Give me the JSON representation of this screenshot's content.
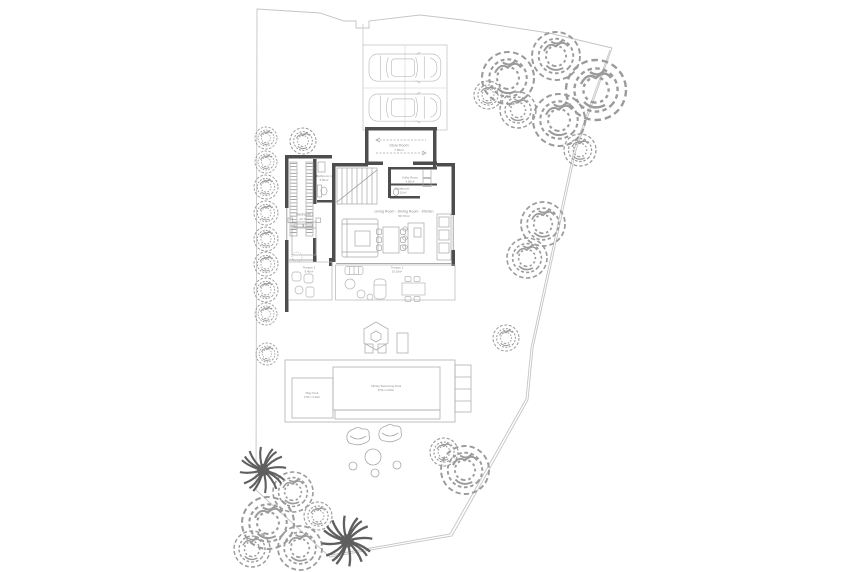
{
  "title": "Villa ground floor site plan",
  "colors": {
    "wall": "#4d4d4d",
    "furniture_line": "#a6a6a6",
    "boundary_line": "#c4c4c4",
    "vegetation_line": "#9b9b9b",
    "label_text": "#8a8a8a",
    "background": "#ffffff"
  },
  "rooms": [
    {
      "name": "Store Room",
      "area": "7.90m²"
    },
    {
      "name": "Bathroom 1",
      "area": "6.50m²"
    },
    {
      "name": "Utility Room",
      "area": "4.50m²"
    },
    {
      "name": "Cloakroom",
      "area": "3.10m²"
    },
    {
      "name": "Living Room · Dining Room · Kitchen",
      "area": "58.70m²"
    },
    {
      "name": "Bedroom 1",
      "area": "23.70m²"
    },
    {
      "name": "Terrace 2",
      "area": "9.40m²"
    },
    {
      "name": "Terrace 1",
      "area": "19.20m²"
    }
  ],
  "pools": [
    {
      "name": "Play Pool",
      "size": "3.50 x 3.40m"
    },
    {
      "name": "Infinity Swimming Pool",
      "size": "8.50 x 4.00m"
    }
  ],
  "objects": {
    "car": "car-top-view",
    "tree": "tree-canopy",
    "palm": "palm-tree",
    "parasol": "parasol-hexagon",
    "stone": "stone-lounger"
  }
}
